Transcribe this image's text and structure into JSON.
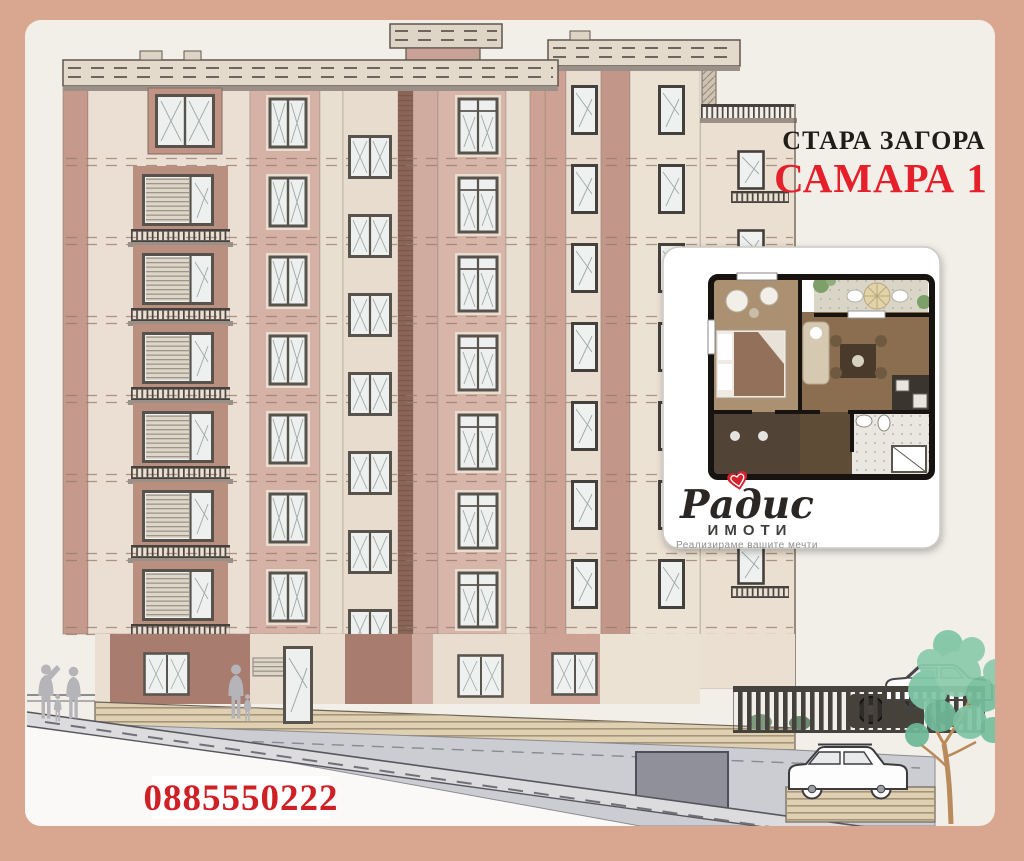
{
  "header": {
    "city": "СТАРА ЗАГОРА",
    "complex": "САМАРА 1"
  },
  "contact": {
    "phone": "0885550222"
  },
  "brand": {
    "name": "Радис",
    "division": "ИМОТИ",
    "tagline": "Реализираме вашите мечти"
  },
  "icons": {
    "logo_heart": "heart-icon",
    "tree": "tree-icon",
    "people": "people-silhouettes"
  },
  "colors": {
    "frame": "#d9a78f",
    "canvas": "#f2efe8",
    "title_black": "#201c18",
    "accent_red": "#e6202b",
    "phone_red": "#cf2026",
    "logo_red": "#d6212e",
    "wall_beige": "#eadfd2",
    "wall_rose": "#d6b2a6",
    "wall_rose_dark": "#a87c6e",
    "stair_stripe_brown": "#8a6557",
    "basement_gray": "#cccdd2",
    "wood_base": "#dfd0b2",
    "tree_green": "#7fc6a5"
  }
}
